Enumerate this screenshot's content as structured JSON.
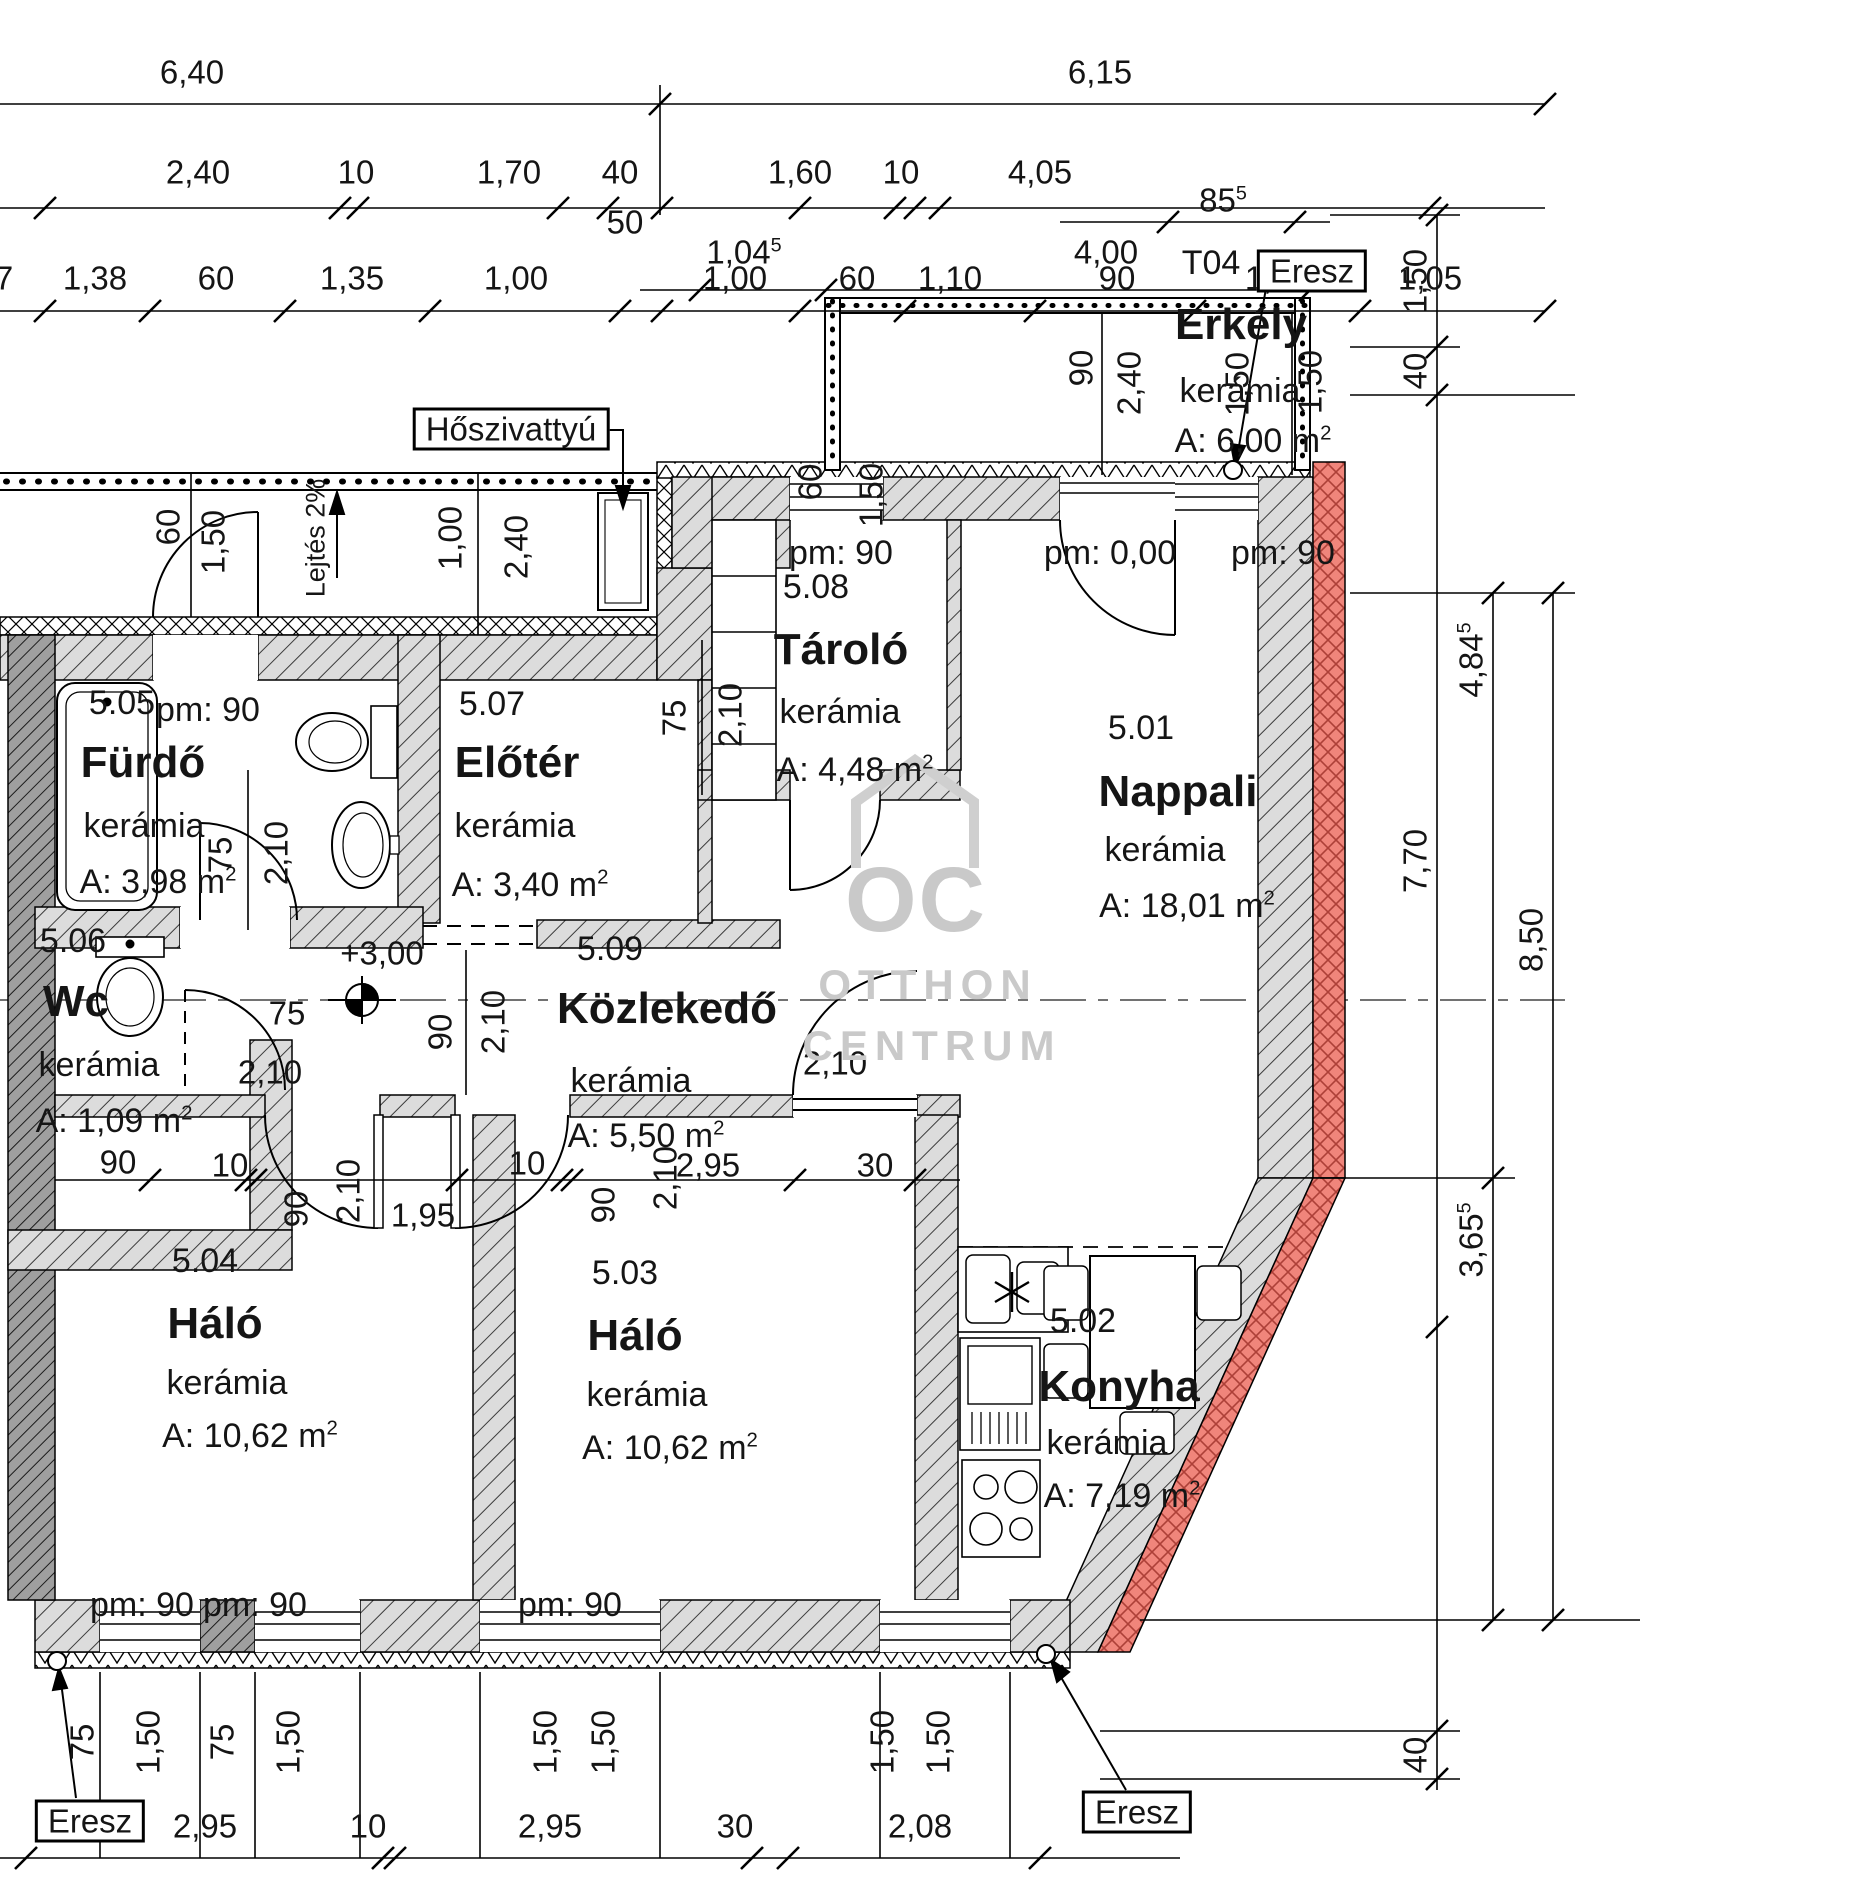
{
  "drawing": {
    "title": "Lakás alaprajz",
    "accent_color": "#f0857b",
    "wall_color": "#dcdcdc",
    "rooms": [
      {
        "number": "5.05",
        "name": "Fürdő",
        "material": "kerámia",
        "area": "A: 3,98 m",
        "area_sup": "2",
        "p_num": [
          122,
          703
        ],
        "p_name": [
          143,
          763
        ],
        "p_mat": [
          144,
          826
        ],
        "p_area": [
          158,
          882
        ]
      },
      {
        "number": "5.06",
        "name": "Wc",
        "material": "kerámia",
        "area": "A: 1,09 m",
        "area_sup": "2",
        "p_num": [
          73,
          941
        ],
        "p_name": [
          76,
          1002
        ],
        "p_mat": [
          99,
          1065
        ],
        "p_area": [
          114,
          1121
        ]
      },
      {
        "number": "5.07",
        "name": "Előtér",
        "material": "kerámia",
        "area": "A: 3,40 m",
        "area_sup": "2",
        "p_num": [
          492,
          704
        ],
        "p_name": [
          517,
          763
        ],
        "p_mat": [
          515,
          826
        ],
        "p_area": [
          530,
          885
        ]
      },
      {
        "number": "5.08",
        "name": "Tároló",
        "material": "kerámia",
        "area": "A: 4,48 m",
        "area_sup": "2",
        "p_num": [
          816,
          587
        ],
        "p_name": [
          841,
          650
        ],
        "p_mat": [
          840,
          712
        ],
        "p_area": [
          855,
          770
        ]
      },
      {
        "number": "5.01",
        "name": "Nappali",
        "material": "kerámia",
        "area": "A: 18,01 m",
        "area_sup": "2",
        "p_num": [
          1141,
          728
        ],
        "p_name": [
          1178,
          792
        ],
        "p_mat": [
          1165,
          850
        ],
        "p_area": [
          1187,
          906
        ]
      },
      {
        "number": "5.09",
        "name": "Közlekedő",
        "material": "kerámia",
        "area": "A: 5,50 m",
        "area_sup": "2",
        "p_num": [
          610,
          949
        ],
        "p_name": [
          667,
          1009
        ],
        "p_mat": [
          631,
          1081
        ],
        "p_area": [
          646,
          1136
        ]
      },
      {
        "number": "5.04",
        "name": "Háló",
        "material": "kerámia",
        "area": "A: 10,62 m",
        "area_sup": "2",
        "p_num": [
          205,
          1261
        ],
        "p_name": [
          215,
          1324
        ],
        "p_mat": [
          227,
          1383
        ],
        "p_area": [
          250,
          1436
        ]
      },
      {
        "number": "5.03",
        "name": "Háló",
        "material": "kerámia",
        "area": "A: 10,62 m",
        "area_sup": "2",
        "p_num": [
          625,
          1273
        ],
        "p_name": [
          635,
          1336
        ],
        "p_mat": [
          647,
          1395
        ],
        "p_area": [
          670,
          1448
        ]
      },
      {
        "number": "5.02",
        "name": "Konyha",
        "material": "kerámia",
        "area": "A: 7,19 m",
        "area_sup": "2",
        "p_num": [
          1083,
          1321
        ],
        "p_name": [
          1119,
          1387
        ],
        "p_mat": [
          1107,
          1443
        ],
        "p_area": [
          1122,
          1496
        ]
      },
      {
        "number": "T04",
        "name": "Erkély",
        "material": "kerámia",
        "area": "A: 6,00 m",
        "area_sup": "2",
        "p_num": [
          1211,
          263
        ],
        "p_name": [
          1241,
          325
        ],
        "p_mat": [
          1240,
          391
        ],
        "p_area": [
          1253,
          441
        ]
      }
    ],
    "parapet_labels": [
      {
        "t": "pm: 90",
        "x": 208,
        "y": 710
      },
      {
        "t": "pm: 90",
        "x": 841,
        "y": 553
      },
      {
        "t": "pm: 0,00",
        "x": 1110,
        "y": 553
      },
      {
        "t": "pm: 90",
        "x": 1283,
        "y": 553
      },
      {
        "t": "pm: 90",
        "x": 142,
        "y": 1605
      },
      {
        "t": "pm: 90",
        "x": 255,
        "y": 1605
      },
      {
        "t": "pm: 90",
        "x": 570,
        "y": 1605
      }
    ],
    "level_marker": {
      "t": "+3,00",
      "x": 382,
      "y": 953
    },
    "dimensions": [
      {
        "t": "6,40",
        "x": 192,
        "y": 72
      },
      {
        "t": "6,15",
        "x": 1100,
        "y": 72
      },
      {
        "t": "2,40",
        "x": 198,
        "y": 172
      },
      {
        "t": "10",
        "x": 356,
        "y": 172
      },
      {
        "t": "1,70",
        "x": 509,
        "y": 172
      },
      {
        "t": "40",
        "x": 620,
        "y": 172
      },
      {
        "t": "50",
        "x": 625,
        "y": 222
      },
      {
        "t": "1,60",
        "x": 800,
        "y": 172
      },
      {
        "t": "10",
        "x": 901,
        "y": 172
      },
      {
        "t": "4,05",
        "x": 1040,
        "y": 172
      },
      {
        "t": "7",
        "x": 4,
        "y": 278
      },
      {
        "t": "1,38",
        "x": 95,
        "y": 278
      },
      {
        "t": "60",
        "x": 216,
        "y": 278
      },
      {
        "t": "1,35",
        "x": 352,
        "y": 278
      },
      {
        "t": "1,00",
        "x": 516,
        "y": 278
      },
      {
        "t": "1,00",
        "x": 735,
        "y": 278
      },
      {
        "t": "60",
        "x": 857,
        "y": 278
      },
      {
        "t": "1,10",
        "x": 950,
        "y": 278
      },
      {
        "t": "90",
        "x": 1117,
        "y": 278
      },
      {
        "t": "1,50",
        "x": 1277,
        "y": 278
      },
      {
        "t": "1,05",
        "x": 1430,
        "y": 278
      },
      {
        "t": "1,04",
        "sup": "5",
        "x": 744,
        "y": 252
      },
      {
        "t": "4,00",
        "x": 1106,
        "y": 252
      },
      {
        "t": "85",
        "sup": "5",
        "x": 1223,
        "y": 200
      },
      {
        "t": "1,50",
        "x": 1415,
        "y": 281,
        "r": 1
      },
      {
        "t": "40",
        "x": 1415,
        "y": 371,
        "r": 1
      },
      {
        "t": "4,84",
        "sup": "5",
        "x": 1471,
        "y": 660,
        "r": 1
      },
      {
        "t": "7,70",
        "x": 1415,
        "y": 861,
        "r": 1
      },
      {
        "t": "8,50",
        "x": 1531,
        "y": 940,
        "r": 1
      },
      {
        "t": "3,65",
        "sup": "5",
        "x": 1471,
        "y": 1240,
        "r": 1
      },
      {
        "t": "40",
        "x": 1415,
        "y": 1755,
        "r": 1
      },
      {
        "t": "60",
        "x": 810,
        "y": 482,
        "r": 1
      },
      {
        "t": "1,50",
        "x": 871,
        "y": 495,
        "r": 1
      },
      {
        "t": "90",
        "x": 1081,
        "y": 368,
        "r": 1
      },
      {
        "t": "2,40",
        "x": 1129,
        "y": 383,
        "r": 1
      },
      {
        "t": "1,50",
        "x": 1237,
        "y": 384,
        "r": 1
      },
      {
        "t": "1,50",
        "x": 1310,
        "y": 382,
        "r": 1
      },
      {
        "t": "60",
        "x": 168,
        "y": 527,
        "r": 1
      },
      {
        "t": "1,50",
        "x": 213,
        "y": 542,
        "r": 1
      },
      {
        "t": "1,00",
        "x": 450,
        "y": 538,
        "r": 1
      },
      {
        "t": "2,40",
        "x": 516,
        "y": 547,
        "r": 1
      },
      {
        "t": "Lejtés 2%",
        "x": 316,
        "y": 538,
        "r": 1,
        "s": 27
      },
      {
        "t": "75",
        "x": 220,
        "y": 855,
        "r": 1
      },
      {
        "t": "2,10",
        "x": 276,
        "y": 853,
        "r": 1
      },
      {
        "t": "75",
        "x": 674,
        "y": 718,
        "r": 1
      },
      {
        "t": "2,10",
        "x": 730,
        "y": 715,
        "r": 1
      },
      {
        "t": "90",
        "x": 440,
        "y": 1032,
        "r": 1
      },
      {
        "t": "2,10",
        "x": 493,
        "y": 1022,
        "r": 1
      },
      {
        "t": "75",
        "x": 287,
        "y": 1013
      },
      {
        "t": "2,10",
        "x": 270,
        "y": 1072
      },
      {
        "t": "90",
        "x": 118,
        "y": 1162
      },
      {
        "t": "10",
        "x": 230,
        "y": 1165
      },
      {
        "t": "90",
        "x": 296,
        "y": 1209,
        "r": 1
      },
      {
        "t": "2,10",
        "x": 348,
        "y": 1191,
        "r": 1
      },
      {
        "t": "1,95",
        "x": 423,
        "y": 1215
      },
      {
        "t": "10",
        "x": 527,
        "y": 1163
      },
      {
        "t": "90",
        "x": 603,
        "y": 1205,
        "r": 1
      },
      {
        "t": "2,10",
        "x": 665,
        "y": 1178,
        "r": 1
      },
      {
        "t": "2,95",
        "x": 708,
        "y": 1165
      },
      {
        "t": "30",
        "x": 875,
        "y": 1165
      },
      {
        "t": "2,10",
        "x": 835,
        "y": 1063
      },
      {
        "t": "75",
        "x": 82,
        "y": 1742,
        "r": 1
      },
      {
        "t": "1,50",
        "x": 148,
        "y": 1742,
        "r": 1
      },
      {
        "t": "75",
        "x": 222,
        "y": 1742,
        "r": 1
      },
      {
        "t": "1,50",
        "x": 288,
        "y": 1742,
        "r": 1
      },
      {
        "t": "1,50",
        "x": 545,
        "y": 1742,
        "r": 1
      },
      {
        "t": "1,50",
        "x": 603,
        "y": 1742,
        "r": 1
      },
      {
        "t": "1,50",
        "x": 882,
        "y": 1742,
        "r": 1
      },
      {
        "t": "1,50",
        "x": 938,
        "y": 1742,
        "r": 1
      },
      {
        "t": "2,95",
        "x": 205,
        "y": 1826
      },
      {
        "t": "10",
        "x": 368,
        "y": 1826
      },
      {
        "t": "2,95",
        "x": 550,
        "y": 1826
      },
      {
        "t": "30",
        "x": 735,
        "y": 1826
      },
      {
        "t": "2,08",
        "x": 920,
        "y": 1826
      }
    ],
    "annotations": [
      {
        "t": "Hőszivattyú",
        "x": 511,
        "y": 429,
        "n": "heatpump-label"
      },
      {
        "t": "Eresz",
        "x": 1312,
        "y": 271,
        "n": "eresz-label-top"
      },
      {
        "t": "Eresz",
        "x": 90,
        "y": 1821,
        "n": "eresz-label-bottom-left"
      },
      {
        "t": "Eresz",
        "x": 1137,
        "y": 1812,
        "n": "eresz-label-bottom-right"
      }
    ],
    "watermark": {
      "logo": "OC",
      "line1": "OTTHON",
      "line2": "CENTRUM"
    }
  }
}
